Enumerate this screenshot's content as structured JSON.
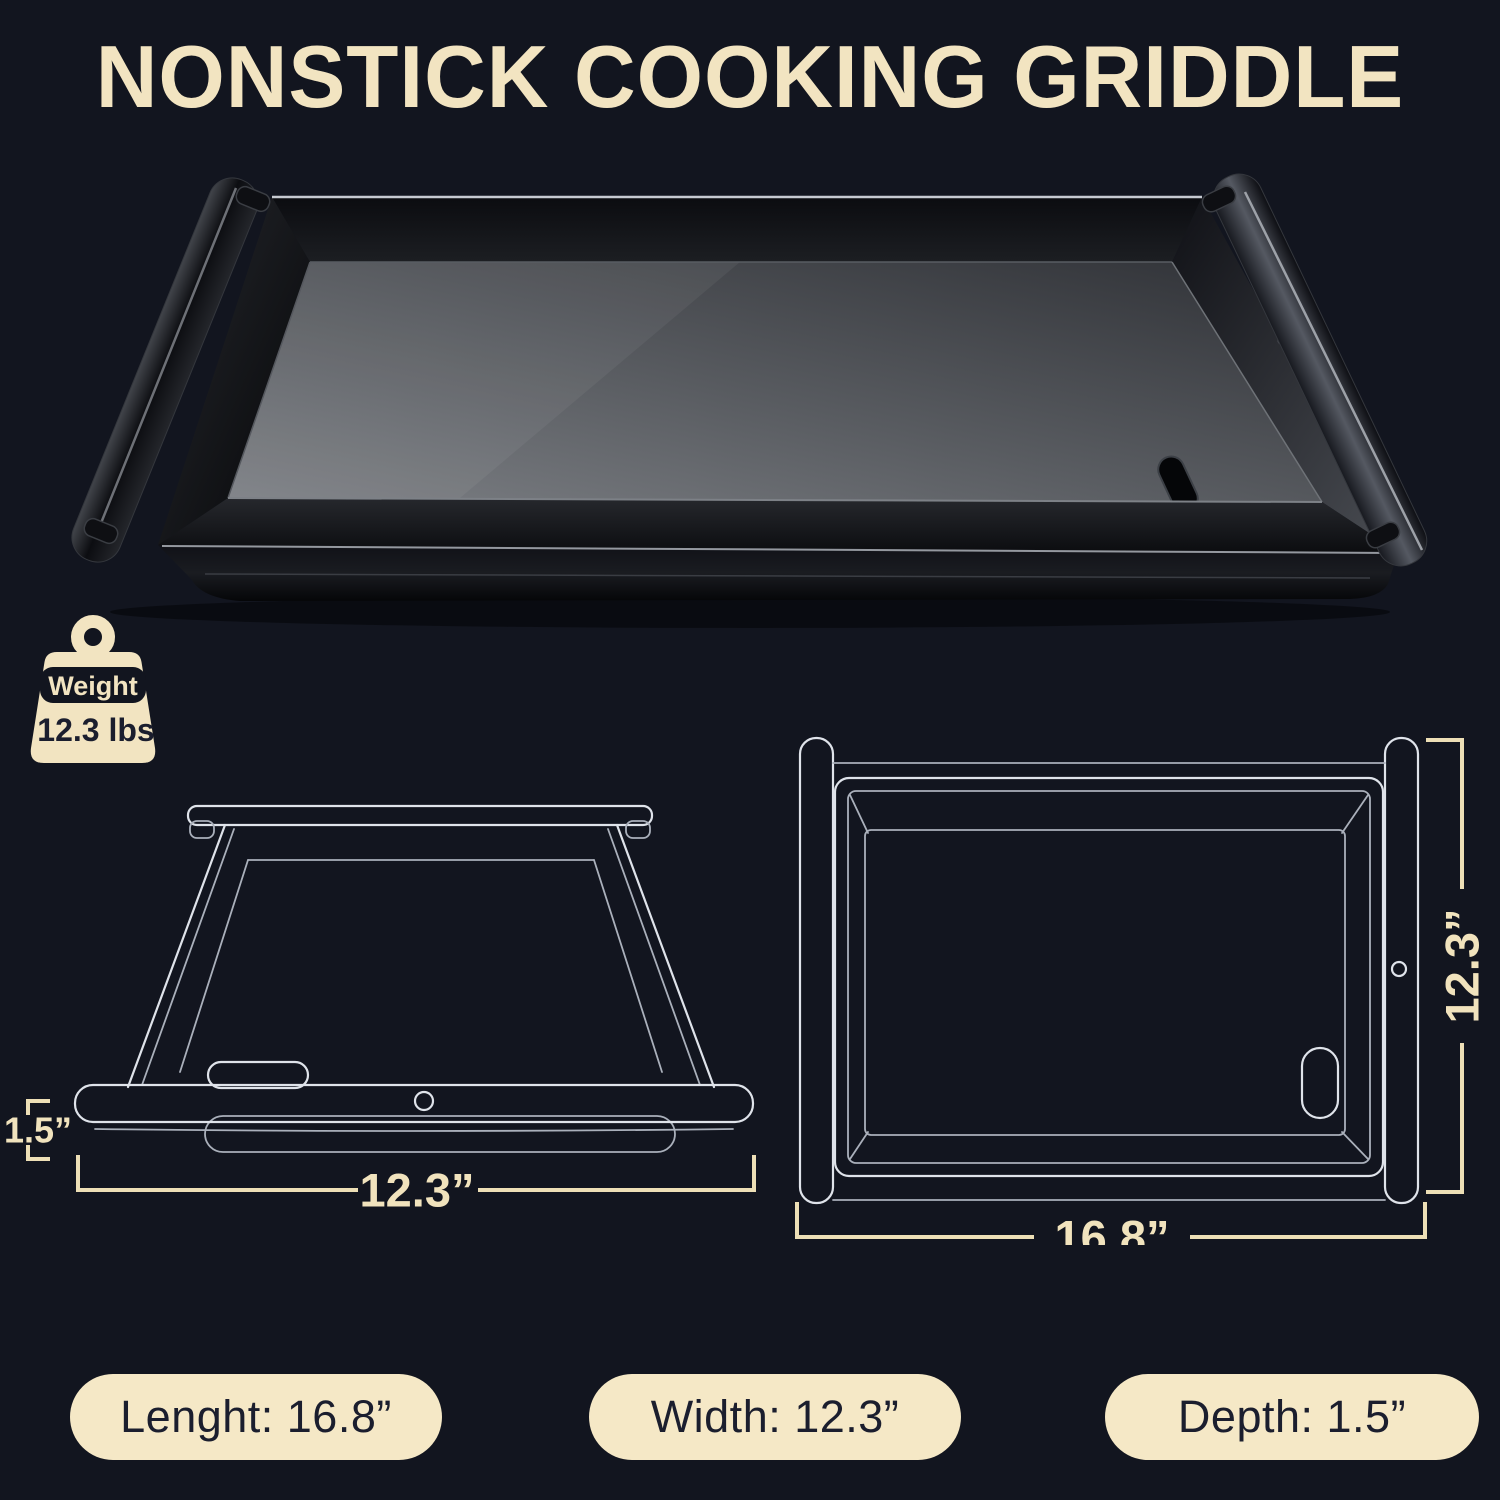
{
  "title": "NONSTICK COOKING GRIDDLE",
  "weight_badge": {
    "label": "Weight",
    "value": "12.3 lbs"
  },
  "diagrams": {
    "side_view": {
      "depth_label": "1.5”",
      "width_label": "12.3”"
    },
    "top_view": {
      "height_label": "12.3”",
      "length_label": "16.8”"
    }
  },
  "spec_badges": [
    {
      "text": "Lenght: 16.8”"
    },
    {
      "text": "Width: 12.3”"
    },
    {
      "text": "Depth: 1.5”"
    }
  ],
  "colors": {
    "background": "#12151f",
    "cream": "#f2e4c1",
    "dark_text": "#1b1e2e",
    "wireframe": "#dfe3ea"
  }
}
